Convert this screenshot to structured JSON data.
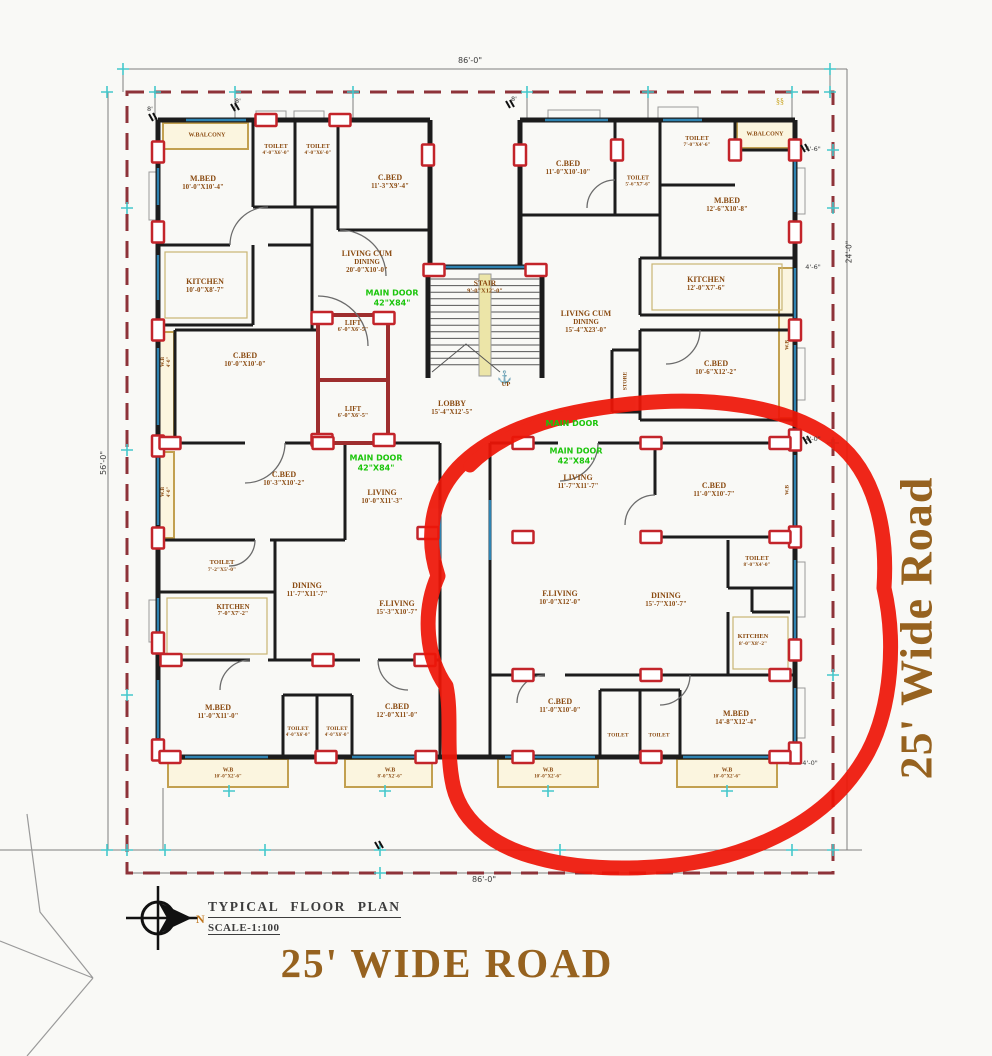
{
  "drawing": {
    "title": "TYPICAL FLOOR PLAN",
    "scale": "SCALE-1:100",
    "north_label": "N",
    "road_bottom": "25' WIDE ROAD",
    "road_right": "25' Wide Road"
  },
  "colors": {
    "room_text": "#8a4a10",
    "road_text": "#96621f",
    "note_text": "#1cc50c",
    "annotation_red": "#ee1507",
    "boundary": "#8e3339",
    "wall": "#1c1c1c",
    "window": "#2e82b0",
    "balcony": "#c2a050",
    "marker_red": "#c3242a"
  },
  "plan": {
    "labels": [
      {
        "l": [
          "M.BED",
          "10'-0\"X10'-4\""
        ],
        "x": 203,
        "y": 183,
        "c": "r"
      },
      {
        "l": [
          "TOILET",
          "4'-0\"X6'-0\""
        ],
        "x": 276,
        "y": 150,
        "c": "r",
        "s": 6.2
      },
      {
        "l": [
          "TOILET",
          "4'-0\"X6'-0\""
        ],
        "x": 318,
        "y": 150,
        "c": "r",
        "s": 6.2
      },
      {
        "l": [
          "C.BED",
          "11'-3\"X9'-4\""
        ],
        "x": 390,
        "y": 182,
        "c": "r"
      },
      {
        "l": [
          "W.BALCONY"
        ],
        "x": 207,
        "y": 136,
        "c": "r",
        "s": 6
      },
      {
        "l": [
          "KITCHEN",
          "10'-0\"X8'-7\""
        ],
        "x": 205,
        "y": 286,
        "c": "r"
      },
      {
        "l": [
          "LIVING CUM",
          "DINING",
          "20'-0\"X10'-0\""
        ],
        "x": 367,
        "y": 262,
        "c": "r"
      },
      {
        "l": [
          "C.BED",
          "10'-0\"X10'-0\""
        ],
        "x": 245,
        "y": 360,
        "c": "r"
      },
      {
        "l": [
          "W.B",
          "4'-0\""
        ],
        "x": 166,
        "y": 362,
        "c": "r",
        "s": 5.5,
        "rot": -90
      },
      {
        "l": [
          "W.B",
          "4'-0\""
        ],
        "x": 166,
        "y": 492,
        "c": "r",
        "s": 5.5,
        "rot": -90
      },
      {
        "l": [
          "STAIR",
          "9'-0\"X12'-0\""
        ],
        "x": 485,
        "y": 287,
        "c": "r",
        "s": 7.5
      },
      {
        "l": [
          "LIFT",
          "6'-0\"X6'-5\""
        ],
        "x": 353,
        "y": 327,
        "c": "r",
        "s": 7
      },
      {
        "l": [
          "LIFT",
          "6'-0\"X6'-5\""
        ],
        "x": 353,
        "y": 413,
        "c": "r",
        "s": 7
      },
      {
        "l": [
          "LOBBY",
          "15'-4\"X12'-5\""
        ],
        "x": 452,
        "y": 408,
        "c": "r"
      },
      {
        "l": [
          "UP"
        ],
        "x": 506,
        "y": 385,
        "c": "r",
        "s": 6.5
      },
      {
        "l": [
          "C.BED",
          "11'-0\"X10'-10\""
        ],
        "x": 568,
        "y": 168,
        "c": "r"
      },
      {
        "l": [
          "TOILET",
          "5'-6\"X7'-6\""
        ],
        "x": 638,
        "y": 182,
        "c": "r",
        "s": 5.8
      },
      {
        "l": [
          "TOILET",
          "7'-0\"X4'-6\""
        ],
        "x": 697,
        "y": 142,
        "c": "r",
        "s": 6.2
      },
      {
        "l": [
          "W.BALCONY"
        ],
        "x": 765,
        "y": 135,
        "c": "r",
        "s": 6
      },
      {
        "l": [
          "M.BED",
          "12'-6\"X10'-8\""
        ],
        "x": 727,
        "y": 205,
        "c": "r"
      },
      {
        "l": [
          "LIVING CUM",
          "DINING",
          "15'-4\"X23'-0\""
        ],
        "x": 586,
        "y": 322,
        "c": "r"
      },
      {
        "l": [
          "KITCHEN",
          "12'-0\"X7'-6\""
        ],
        "x": 706,
        "y": 284,
        "c": "r"
      },
      {
        "l": [
          "C.BED",
          "10'-6\"X12'-2\""
        ],
        "x": 716,
        "y": 368,
        "c": "r"
      },
      {
        "l": [
          "STORE"
        ],
        "x": 626,
        "y": 381,
        "c": "r",
        "s": 5.5,
        "rot": -90
      },
      {
        "l": [
          "W.B"
        ],
        "x": 788,
        "y": 345,
        "c": "r",
        "s": 5.5,
        "rot": -90
      },
      {
        "l": [
          "C.BED",
          "10'-3\"X10'-2\""
        ],
        "x": 284,
        "y": 479,
        "c": "r"
      },
      {
        "l": [
          "LIVING",
          "10'-0\"X11'-3\""
        ],
        "x": 382,
        "y": 497,
        "c": "r"
      },
      {
        "l": [
          "TOILET",
          "7'-2\"X5'-0\""
        ],
        "x": 222,
        "y": 566,
        "c": "r",
        "s": 6.5
      },
      {
        "l": [
          "KITCHEN",
          "7'-0\"X7'-2\""
        ],
        "x": 233,
        "y": 611,
        "c": "r",
        "s": 7
      },
      {
        "l": [
          "DINING",
          "11'-7\"X11'-7\""
        ],
        "x": 307,
        "y": 590,
        "c": "r"
      },
      {
        "l": [
          "F.LIVING",
          "15'-3\"X10'-7\""
        ],
        "x": 397,
        "y": 608,
        "c": "r"
      },
      {
        "l": [
          "M.BED",
          "11'-0\"X11'-0\""
        ],
        "x": 218,
        "y": 712,
        "c": "r"
      },
      {
        "l": [
          "TOILET",
          "4'-0\"X6'-0\""
        ],
        "x": 298,
        "y": 732,
        "c": "r",
        "s": 5.6
      },
      {
        "l": [
          "TOILET",
          "4'-0\"X6'-0\""
        ],
        "x": 337,
        "y": 732,
        "c": "r",
        "s": 5.6
      },
      {
        "l": [
          "C.BED",
          "12'-0\"X11'-0\""
        ],
        "x": 397,
        "y": 711,
        "c": "r"
      },
      {
        "l": [
          "W.B",
          "10'-0\"X2'-6\""
        ],
        "x": 228,
        "y": 774,
        "c": "r",
        "s": 5.8
      },
      {
        "l": [
          "W.B",
          "8'-0\"X2'-6\""
        ],
        "x": 390,
        "y": 774,
        "c": "r",
        "s": 5.8
      },
      {
        "l": [
          "LIVING",
          "11'-7\"X11'-7\""
        ],
        "x": 578,
        "y": 482,
        "c": "r"
      },
      {
        "l": [
          "C.BED",
          "11'-0\"X10'-7\""
        ],
        "x": 714,
        "y": 490,
        "c": "r"
      },
      {
        "l": [
          "W.B"
        ],
        "x": 788,
        "y": 490,
        "c": "r",
        "s": 5.5,
        "rot": -90
      },
      {
        "l": [
          "TOILET",
          "8'-0\"X4'-0\""
        ],
        "x": 757,
        "y": 562,
        "c": "r",
        "s": 6.2
      },
      {
        "l": [
          "KITCHEN",
          "8'-0\"X8'-2\""
        ],
        "x": 753,
        "y": 640,
        "c": "r",
        "s": 6.5
      },
      {
        "l": [
          "F.LIVING",
          "10'-0\"X12'-0\""
        ],
        "x": 560,
        "y": 598,
        "c": "r"
      },
      {
        "l": [
          "DINING",
          "15'-7\"X10'-7\""
        ],
        "x": 666,
        "y": 600,
        "c": "r"
      },
      {
        "l": [
          "C.BED",
          "11'-0\"X10'-0\""
        ],
        "x": 560,
        "y": 706,
        "c": "r"
      },
      {
        "l": [
          "TOILET"
        ],
        "x": 618,
        "y": 736,
        "c": "r",
        "s": 5.5
      },
      {
        "l": [
          "TOILET"
        ],
        "x": 659,
        "y": 736,
        "c": "r",
        "s": 5.5
      },
      {
        "l": [
          "M.BED",
          "14'-8\"X12'-4\""
        ],
        "x": 736,
        "y": 718,
        "c": "r"
      },
      {
        "l": [
          "W.B",
          "10'-0\"X2'-6\""
        ],
        "x": 548,
        "y": 774,
        "c": "r",
        "s": 5.8
      },
      {
        "l": [
          "W.B",
          "10'-0\"X2'-6\""
        ],
        "x": 727,
        "y": 774,
        "c": "r",
        "s": 5.8
      },
      {
        "l": [
          "MAIN DOOR",
          "42\"X84\""
        ],
        "x": 392,
        "y": 298,
        "c": "n"
      },
      {
        "l": [
          "MAIN DOOR",
          "42\"X84\""
        ],
        "x": 376,
        "y": 463,
        "c": "n"
      },
      {
        "l": [
          "MAIN DOOR",
          "42\"X84\""
        ],
        "x": 576,
        "y": 456,
        "c": "n"
      },
      {
        "l": [
          "MAIN DOOR"
        ],
        "x": 572,
        "y": 424,
        "c": "n"
      },
      {
        "l": [
          "86'-0\""
        ],
        "x": 470,
        "y": 61,
        "c": "d",
        "s": 8
      },
      {
        "l": [
          "86'-0\""
        ],
        "x": 484,
        "y": 880,
        "c": "d",
        "s": 8
      },
      {
        "l": [
          "56'-0\""
        ],
        "x": 104,
        "y": 463,
        "c": "d",
        "s": 8,
        "rot": -90
      },
      {
        "l": [
          "24'-0\""
        ],
        "x": 849,
        "y": 252,
        "c": "d",
        "s": 7.5,
        "rot": -90
      },
      {
        "l": [
          "4'-6\""
        ],
        "x": 813,
        "y": 150,
        "c": "d",
        "s": 6.5
      },
      {
        "l": [
          "4'-6\""
        ],
        "x": 813,
        "y": 268,
        "c": "d",
        "s": 6.5
      },
      {
        "l": [
          "4'-0\""
        ],
        "x": 813,
        "y": 440,
        "c": "d",
        "s": 6.5
      },
      {
        "l": [
          "4'-0\""
        ],
        "x": 810,
        "y": 764,
        "c": "d",
        "s": 6.5
      },
      {
        "l": [
          "8'"
        ],
        "x": 150,
        "y": 110,
        "c": "d",
        "s": 6.5
      },
      {
        "l": [
          "8'"
        ],
        "x": 238,
        "y": 102,
        "c": "d",
        "s": 6.5
      },
      {
        "l": [
          "8'"
        ],
        "x": 514,
        "y": 100,
        "c": "d",
        "s": 6.5
      }
    ]
  }
}
